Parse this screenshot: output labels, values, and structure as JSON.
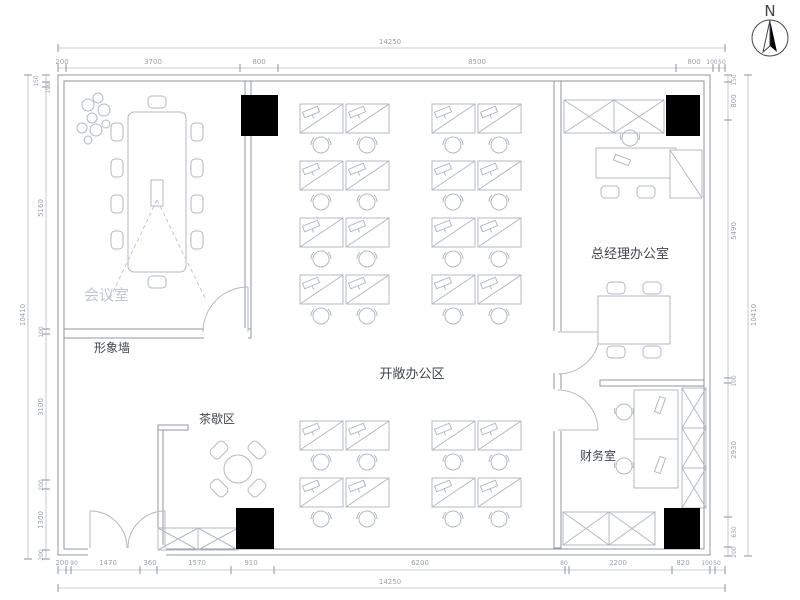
{
  "plan_title": "office-floor-plan",
  "compass": {
    "north_label": "N"
  },
  "rooms": {
    "meeting_room": "会议室",
    "image_wall": "形象墙",
    "tea_area": "茶歇区",
    "open_office": "开敞办公区",
    "gm_office": "总经理办公室",
    "finance_room": "财务室"
  },
  "dimensions": {
    "top": {
      "overall": "14250",
      "segments": [
        "200",
        "3700",
        "800",
        "8500",
        "800",
        "100",
        "50"
      ]
    },
    "bottom": {
      "overall": "14250",
      "segments": [
        "200",
        "90",
        "1470",
        "360",
        "1570",
        "910",
        "6200",
        "80",
        "2200",
        "820",
        "100",
        "50"
      ]
    },
    "left": {
      "overall": "10410",
      "segments": [
        "150",
        "100",
        "5160",
        "100",
        "3100",
        "200",
        "1300",
        "200"
      ]
    },
    "right": {
      "overall": "10410",
      "segments": [
        "150",
        "800",
        "5490",
        "100",
        "2930",
        "630",
        "200"
      ]
    }
  },
  "colors": {
    "background": "#ffffff",
    "wall_line": "#8f979f",
    "furniture_line": "#b3bac0",
    "dimension_text": "#9aa1a8",
    "label_text": "#41464c",
    "faint_label": "#c2c7cd",
    "column_fill": "#000000"
  }
}
